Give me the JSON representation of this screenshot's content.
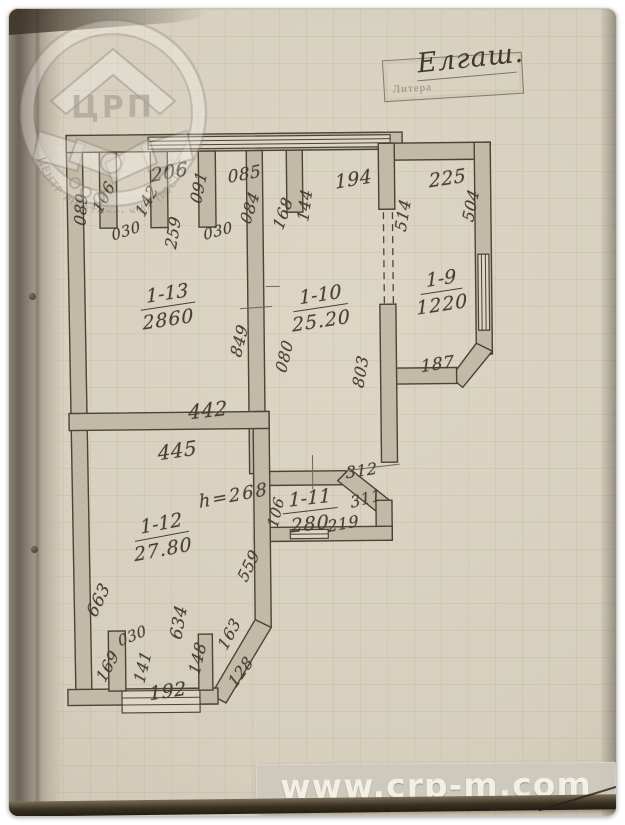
{
  "site_watermark": {
    "text": "www.crp-m.com"
  },
  "logo": {
    "acronym": "ЦРП",
    "ring_text": "ЦЕНТР РІЕЛТОРСЬКИХ ПОСЛУГ"
  },
  "litera_box": {
    "label": "Литера",
    "value": "Елгаш."
  },
  "colors": {
    "page": "#d6cfbd",
    "wall_fill": "#c2b9a6",
    "ink": "#473f32",
    "watermark_text": "#f2efe7"
  },
  "plan": {
    "rooms": [
      {
        "number": "1-13",
        "area": "2860",
        "x": 160,
        "y": 297,
        "rot": -8
      },
      {
        "number": "1-10",
        "area": "25.20",
        "x": 313,
        "y": 300,
        "rot": -8
      },
      {
        "number": "1-9",
        "area": "1220",
        "x": 434,
        "y": 285,
        "rot": -8
      },
      {
        "number": "1-12",
        "area": "27.80",
        "x": 152,
        "y": 527,
        "rot": -10
      },
      {
        "number": "1-11",
        "area": "280",
        "x": 300,
        "y": 503,
        "rot": -6
      }
    ],
    "height_note": {
      "text": "h=268",
      "x": 224,
      "y": 486,
      "rot": -10
    },
    "dimensions": [
      {
        "t": "206",
        "x": 163,
        "y": 162,
        "r": -10,
        "s": 19
      },
      {
        "t": "085",
        "x": 238,
        "y": 165,
        "r": -10,
        "s": 17
      },
      {
        "t": "091",
        "x": 192,
        "y": 177,
        "r": -78,
        "s": 16
      },
      {
        "t": "142",
        "x": 140,
        "y": 190,
        "r": -62,
        "s": 16
      },
      {
        "t": "106",
        "x": 97,
        "y": 186,
        "r": -62,
        "s": 16
      },
      {
        "t": "089",
        "x": 74,
        "y": 198,
        "r": -86,
        "s": 16
      },
      {
        "t": "030",
        "x": 119,
        "y": 220,
        "r": -18,
        "s": 15
      },
      {
        "t": "259",
        "x": 166,
        "y": 222,
        "r": -80,
        "s": 16
      },
      {
        "t": "030",
        "x": 211,
        "y": 221,
        "r": -15,
        "s": 15
      },
      {
        "t": "084",
        "x": 243,
        "y": 198,
        "r": -72,
        "s": 16
      },
      {
        "t": "168",
        "x": 276,
        "y": 204,
        "r": -70,
        "s": 16
      },
      {
        "t": "144",
        "x": 298,
        "y": 196,
        "r": -82,
        "s": 16
      },
      {
        "t": "194",
        "x": 347,
        "y": 171,
        "r": -9,
        "s": 19
      },
      {
        "t": "225",
        "x": 441,
        "y": 171,
        "r": -8,
        "s": 19
      },
      {
        "t": "514",
        "x": 396,
        "y": 207,
        "r": -80,
        "s": 16
      },
      {
        "t": "504",
        "x": 464,
        "y": 198,
        "r": -78,
        "s": 16
      },
      {
        "t": "849",
        "x": 231,
        "y": 331,
        "r": -76,
        "s": 16
      },
      {
        "t": "080",
        "x": 276,
        "y": 347,
        "r": -76,
        "s": 16
      },
      {
        "t": "803",
        "x": 352,
        "y": 363,
        "r": -80,
        "s": 16
      },
      {
        "t": "187",
        "x": 429,
        "y": 357,
        "r": -8,
        "s": 17
      },
      {
        "t": "442",
        "x": 199,
        "y": 400,
        "r": -6,
        "s": 20
      },
      {
        "t": "445",
        "x": 168,
        "y": 440,
        "r": -8,
        "s": 20
      },
      {
        "t": "312",
        "x": 352,
        "y": 462,
        "r": -8,
        "s": 16
      },
      {
        "t": "311",
        "x": 356,
        "y": 490,
        "r": -14,
        "s": 16
      },
      {
        "t": "219",
        "x": 333,
        "y": 515,
        "r": -10,
        "s": 16
      },
      {
        "t": "106",
        "x": 266,
        "y": 503,
        "r": -76,
        "s": 15
      },
      {
        "t": "559",
        "x": 238,
        "y": 556,
        "r": -64,
        "s": 16
      },
      {
        "t": "663",
        "x": 88,
        "y": 589,
        "r": -64,
        "s": 17
      },
      {
        "t": "030",
        "x": 121,
        "y": 625,
        "r": -22,
        "s": 15
      },
      {
        "t": "169",
        "x": 96,
        "y": 655,
        "r": -62,
        "s": 16
      },
      {
        "t": "141",
        "x": 131,
        "y": 656,
        "r": -76,
        "s": 16
      },
      {
        "t": "634",
        "x": 168,
        "y": 612,
        "r": -80,
        "s": 17
      },
      {
        "t": "148",
        "x": 186,
        "y": 648,
        "r": -76,
        "s": 16
      },
      {
        "t": "163",
        "x": 218,
        "y": 624,
        "r": -62,
        "s": 16
      },
      {
        "t": "128",
        "x": 229,
        "y": 662,
        "r": -54,
        "s": 16
      },
      {
        "t": "192",
        "x": 156,
        "y": 681,
        "r": -8,
        "s": 19
      }
    ]
  }
}
